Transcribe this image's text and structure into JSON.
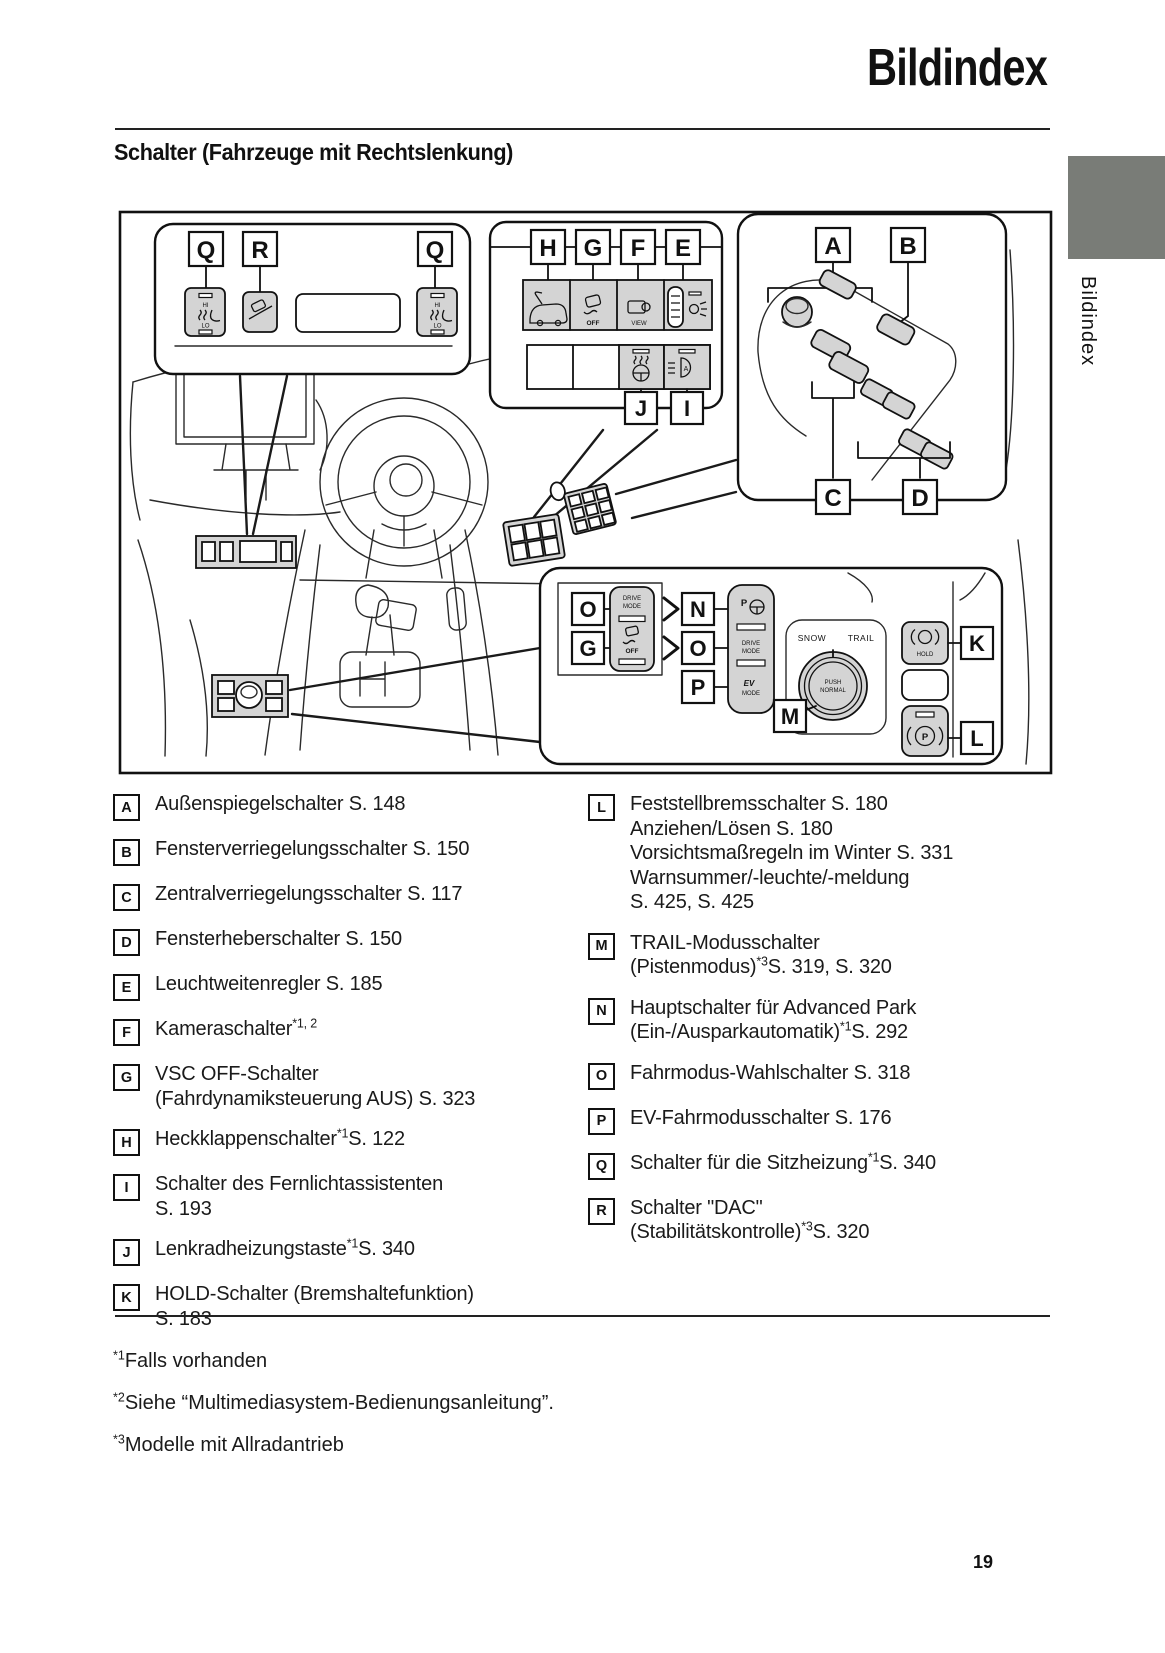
{
  "page": {
    "title": "Bildindex",
    "section_title": "Schalter (Fahrzeuge mit Rechtslenkung)",
    "side_label": "Bildindex",
    "page_number": "19",
    "tab_color": "#797c77"
  },
  "diagram": {
    "callouts": {
      "a": "A",
      "b": "B",
      "c": "C",
      "d": "D",
      "e": "E",
      "f": "F",
      "g": "G",
      "h": "H",
      "i": "I",
      "j": "J",
      "k": "K",
      "l": "L",
      "m": "M",
      "n": "N",
      "o": "O",
      "p": "P",
      "q": "Q",
      "r": "R"
    },
    "texts": {
      "hi": "HI",
      "lo": "LO",
      "off": "OFF",
      "view": "VIEW",
      "drive": "DRIVE",
      "mode": "MODE",
      "ev": "EV",
      "p": "P",
      "a_beam": "A",
      "snow": "SNOW",
      "trail": "TRAIL",
      "push": "PUSH",
      "normal": "NORMAL",
      "hold": "HOLD"
    }
  },
  "legend": {
    "left": [
      {
        "letter": "A",
        "lines": [
          {
            "a": "Außenspiegelschalter S. 148"
          }
        ]
      },
      {
        "letter": "B",
        "lines": [
          {
            "a": "Fensterverriegelungsschalter S. 150"
          }
        ]
      },
      {
        "letter": "C",
        "lines": [
          {
            "a": "Zentralverriegelungsschalter S. 117"
          }
        ]
      },
      {
        "letter": "D",
        "lines": [
          {
            "a": "Fensterheberschalter S. 150"
          }
        ]
      },
      {
        "letter": "E",
        "lines": [
          {
            "a": "Leuchtweitenregler S. 185"
          }
        ]
      },
      {
        "letter": "F",
        "lines": [
          {
            "a": "Kameraschalter",
            "sup": "*1, 2"
          }
        ]
      },
      {
        "letter": "G",
        "lines": [
          {
            "a": "VSC OFF-Schalter"
          },
          {
            "a": "(Fahrdynamiksteuerung AUS) S. 323"
          }
        ]
      },
      {
        "letter": "H",
        "lines": [
          {
            "a": "Heckklappenschalter",
            "sup": "*1",
            "b": "S. 122"
          }
        ]
      },
      {
        "letter": "I",
        "lines": [
          {
            "a": "Schalter des Fernlichtassistenten"
          },
          {
            "a": "S. 193"
          }
        ]
      },
      {
        "letter": "J",
        "lines": [
          {
            "a": "Lenkradheizungstaste",
            "sup": "*1",
            "b": "S. 340"
          }
        ]
      },
      {
        "letter": "K",
        "lines": [
          {
            "a": "HOLD-Schalter (Bremshaltefunktion)"
          },
          {
            "a": "S. 183"
          }
        ]
      }
    ],
    "right": [
      {
        "letter": "L",
        "lines": [
          {
            "a": "Feststellbremsschalter S. 180"
          },
          {
            "a": "Anziehen/Lösen S. 180"
          },
          {
            "a": "Vorsichtsmaßregeln im Winter S. 331"
          },
          {
            "a": "Warnsummer/-leuchte/-meldung"
          },
          {
            "a": "S. 425, S. 425"
          }
        ]
      },
      {
        "letter": "M",
        "lines": [
          {
            "a": "TRAIL-Modusschalter"
          },
          {
            "a": "(Pistenmodus)",
            "sup": "*3",
            "b": "S. 319, S. 320"
          }
        ]
      },
      {
        "letter": "N",
        "lines": [
          {
            "a": "Hauptschalter für Advanced Park"
          },
          {
            "a": "(Ein-/Ausparkautomatik)",
            "sup": "*1",
            "b": "S. 292"
          }
        ]
      },
      {
        "letter": "O",
        "lines": [
          {
            "a": "Fahrmodus-Wahlschalter S. 318"
          }
        ]
      },
      {
        "letter": "P",
        "lines": [
          {
            "a": "EV-Fahrmodusschalter S. 176"
          }
        ]
      },
      {
        "letter": "Q",
        "lines": [
          {
            "a": "Schalter für die Sitzheizung",
            "sup": "*1",
            "b": "S. 340"
          }
        ]
      },
      {
        "letter": "R",
        "lines": [
          {
            "a": "Schalter \"DAC\""
          },
          {
            "a": "(Stabilitätskontrolle)",
            "sup": "*3",
            "b": "S. 320"
          }
        ]
      }
    ]
  },
  "footnotes": [
    {
      "sup": "*1",
      "text": "Falls vorhanden"
    },
    {
      "sup": "*2",
      "text": "Siehe “Multimediasystem-Bedienungsanleitung”."
    },
    {
      "sup": "*3",
      "text": "Modelle mit Allradantrieb"
    }
  ]
}
